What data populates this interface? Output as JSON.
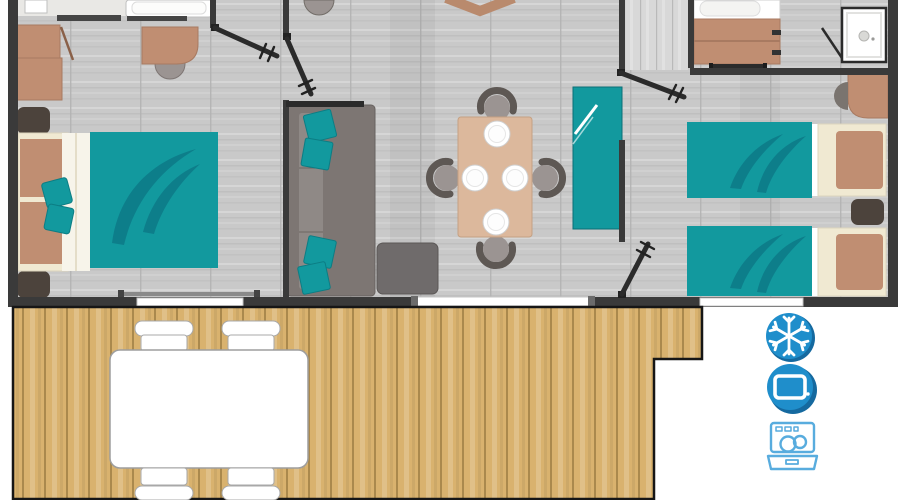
{
  "title": "Mobile home floor plan with terrace",
  "canvas": {
    "width": 900,
    "height": 500
  },
  "colors": {
    "wall": "#3a3a3a",
    "outline": "#1c1c1c",
    "door": "#2b2b2b",
    "floor": "#c9c9c9",
    "floorSeam": "#b3b3b3",
    "hallFloor": "#d8d8d8",
    "teal": "#12999e",
    "tealDark": "#0d7e8a",
    "cream": "#f0e9d2",
    "brown": "#c08e72",
    "brownDark": "#a87a61",
    "darkUnit": "#4c433c",
    "sofa": "#7d7673",
    "sofaSeat": "#8f8986",
    "tableTan": "#dcb89c",
    "chairGray": "#9b9492",
    "chairDark": "#5e5854",
    "cabinetGray": "#6f6b6b",
    "wood": "#d9b26e",
    "woodSeam": "#aa894d",
    "iconBlue": "#1f8ecb",
    "iconShadow": "#15699f",
    "iconStroke": "#58acde"
  },
  "rooms": [
    {
      "name": "master-bedroom",
      "furniture": [
        "double-bed",
        "wardrobe",
        "desk",
        "desk-chair",
        "nightstand",
        "nightstand"
      ]
    },
    {
      "name": "living-room",
      "furniture": [
        "sofa",
        "dining-table",
        "dining-chairs-x4",
        "plates-x4",
        "tv-cabinet"
      ]
    },
    {
      "name": "kitchen",
      "furniture": [
        "teal-counter",
        "counter-corner",
        "stool"
      ]
    },
    {
      "name": "hallway",
      "furniture": []
    },
    {
      "name": "bathroom",
      "furniture": [
        "washbasin-vanity",
        "shower",
        "sliding-door"
      ]
    },
    {
      "name": "twin-bedroom",
      "furniture": [
        "single-bed",
        "single-bed",
        "nightstand",
        "wardrobe"
      ]
    },
    {
      "name": "terrace",
      "furniture": [
        "outdoor-table",
        "outdoor-chairs-x4"
      ]
    }
  ],
  "amenities": [
    {
      "name": "air-conditioning",
      "icon": "snowflake-icon"
    },
    {
      "name": "tv",
      "icon": "tv-icon"
    },
    {
      "name": "dishwasher",
      "icon": "dishwasher-icon"
    }
  ]
}
